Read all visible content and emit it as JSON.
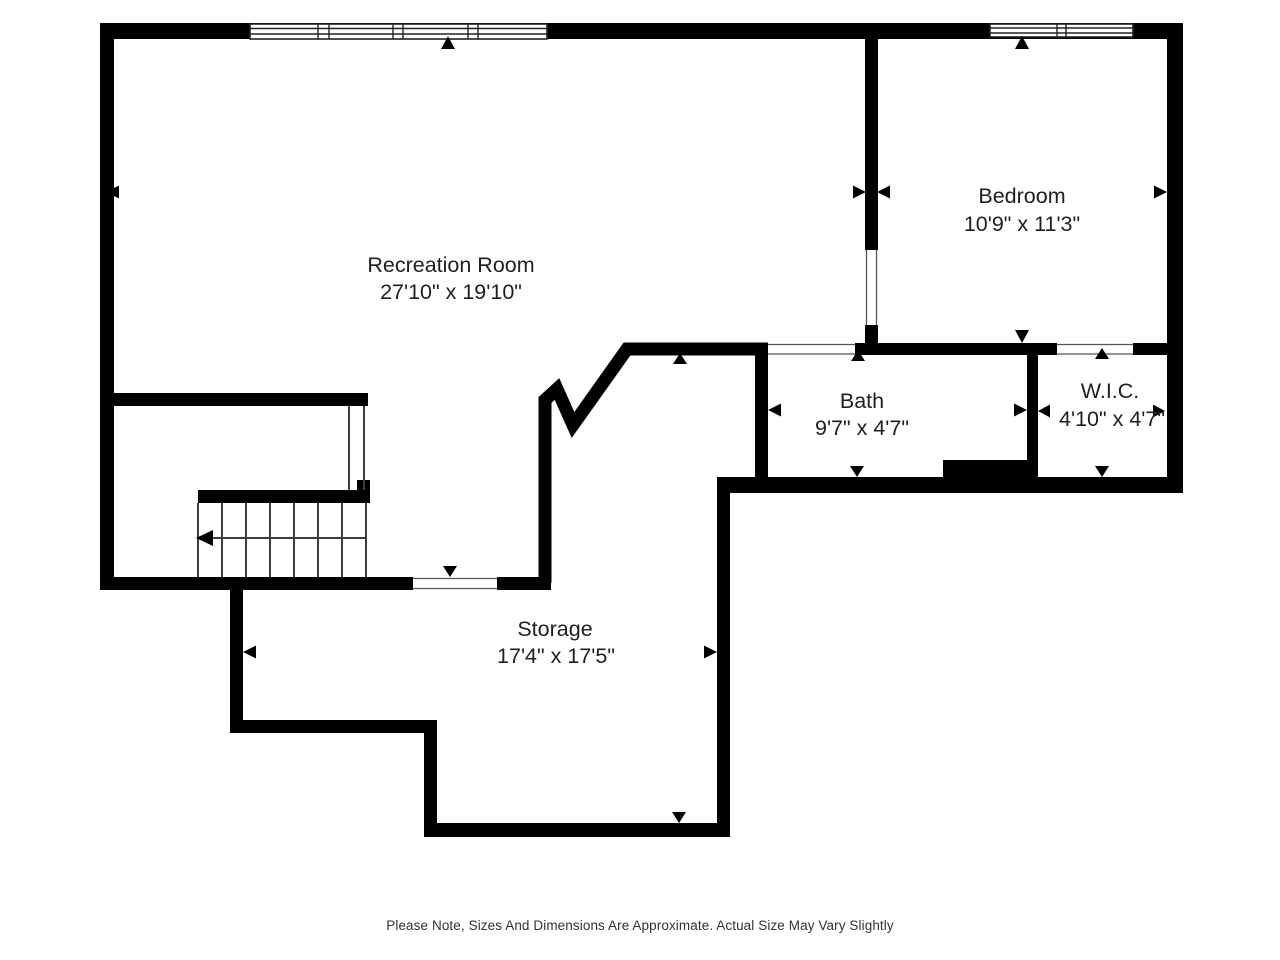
{
  "colors": {
    "background": "#ffffff",
    "wall": "#000000",
    "thin_line": "#3d3d3d",
    "label_text": "#1f1f1f",
    "footer_text": "#333333"
  },
  "rooms": [
    {
      "id": "recreation-room",
      "name": "Recreation Room",
      "dimensions": "27'10\" x 19'10\""
    },
    {
      "id": "bedroom",
      "name": "Bedroom",
      "dimensions": "10'9\" x 11'3\""
    },
    {
      "id": "bath",
      "name": "Bath",
      "dimensions": "9'7\" x 4'7\""
    },
    {
      "id": "wic",
      "name": "W.I.C.",
      "dimensions": "4'10\" x 4'7\""
    },
    {
      "id": "storage",
      "name": "Storage",
      "dimensions": "17'4\" x 17'5\""
    }
  ],
  "icons": {
    "dimension_marker": "small solid triangle pointing at wall",
    "stair_direction_marker": "left arrow along stair run"
  },
  "footer": {
    "note": "Please Note, Sizes And Dimensions Are Approximate. Actual Size May Vary Slightly"
  }
}
